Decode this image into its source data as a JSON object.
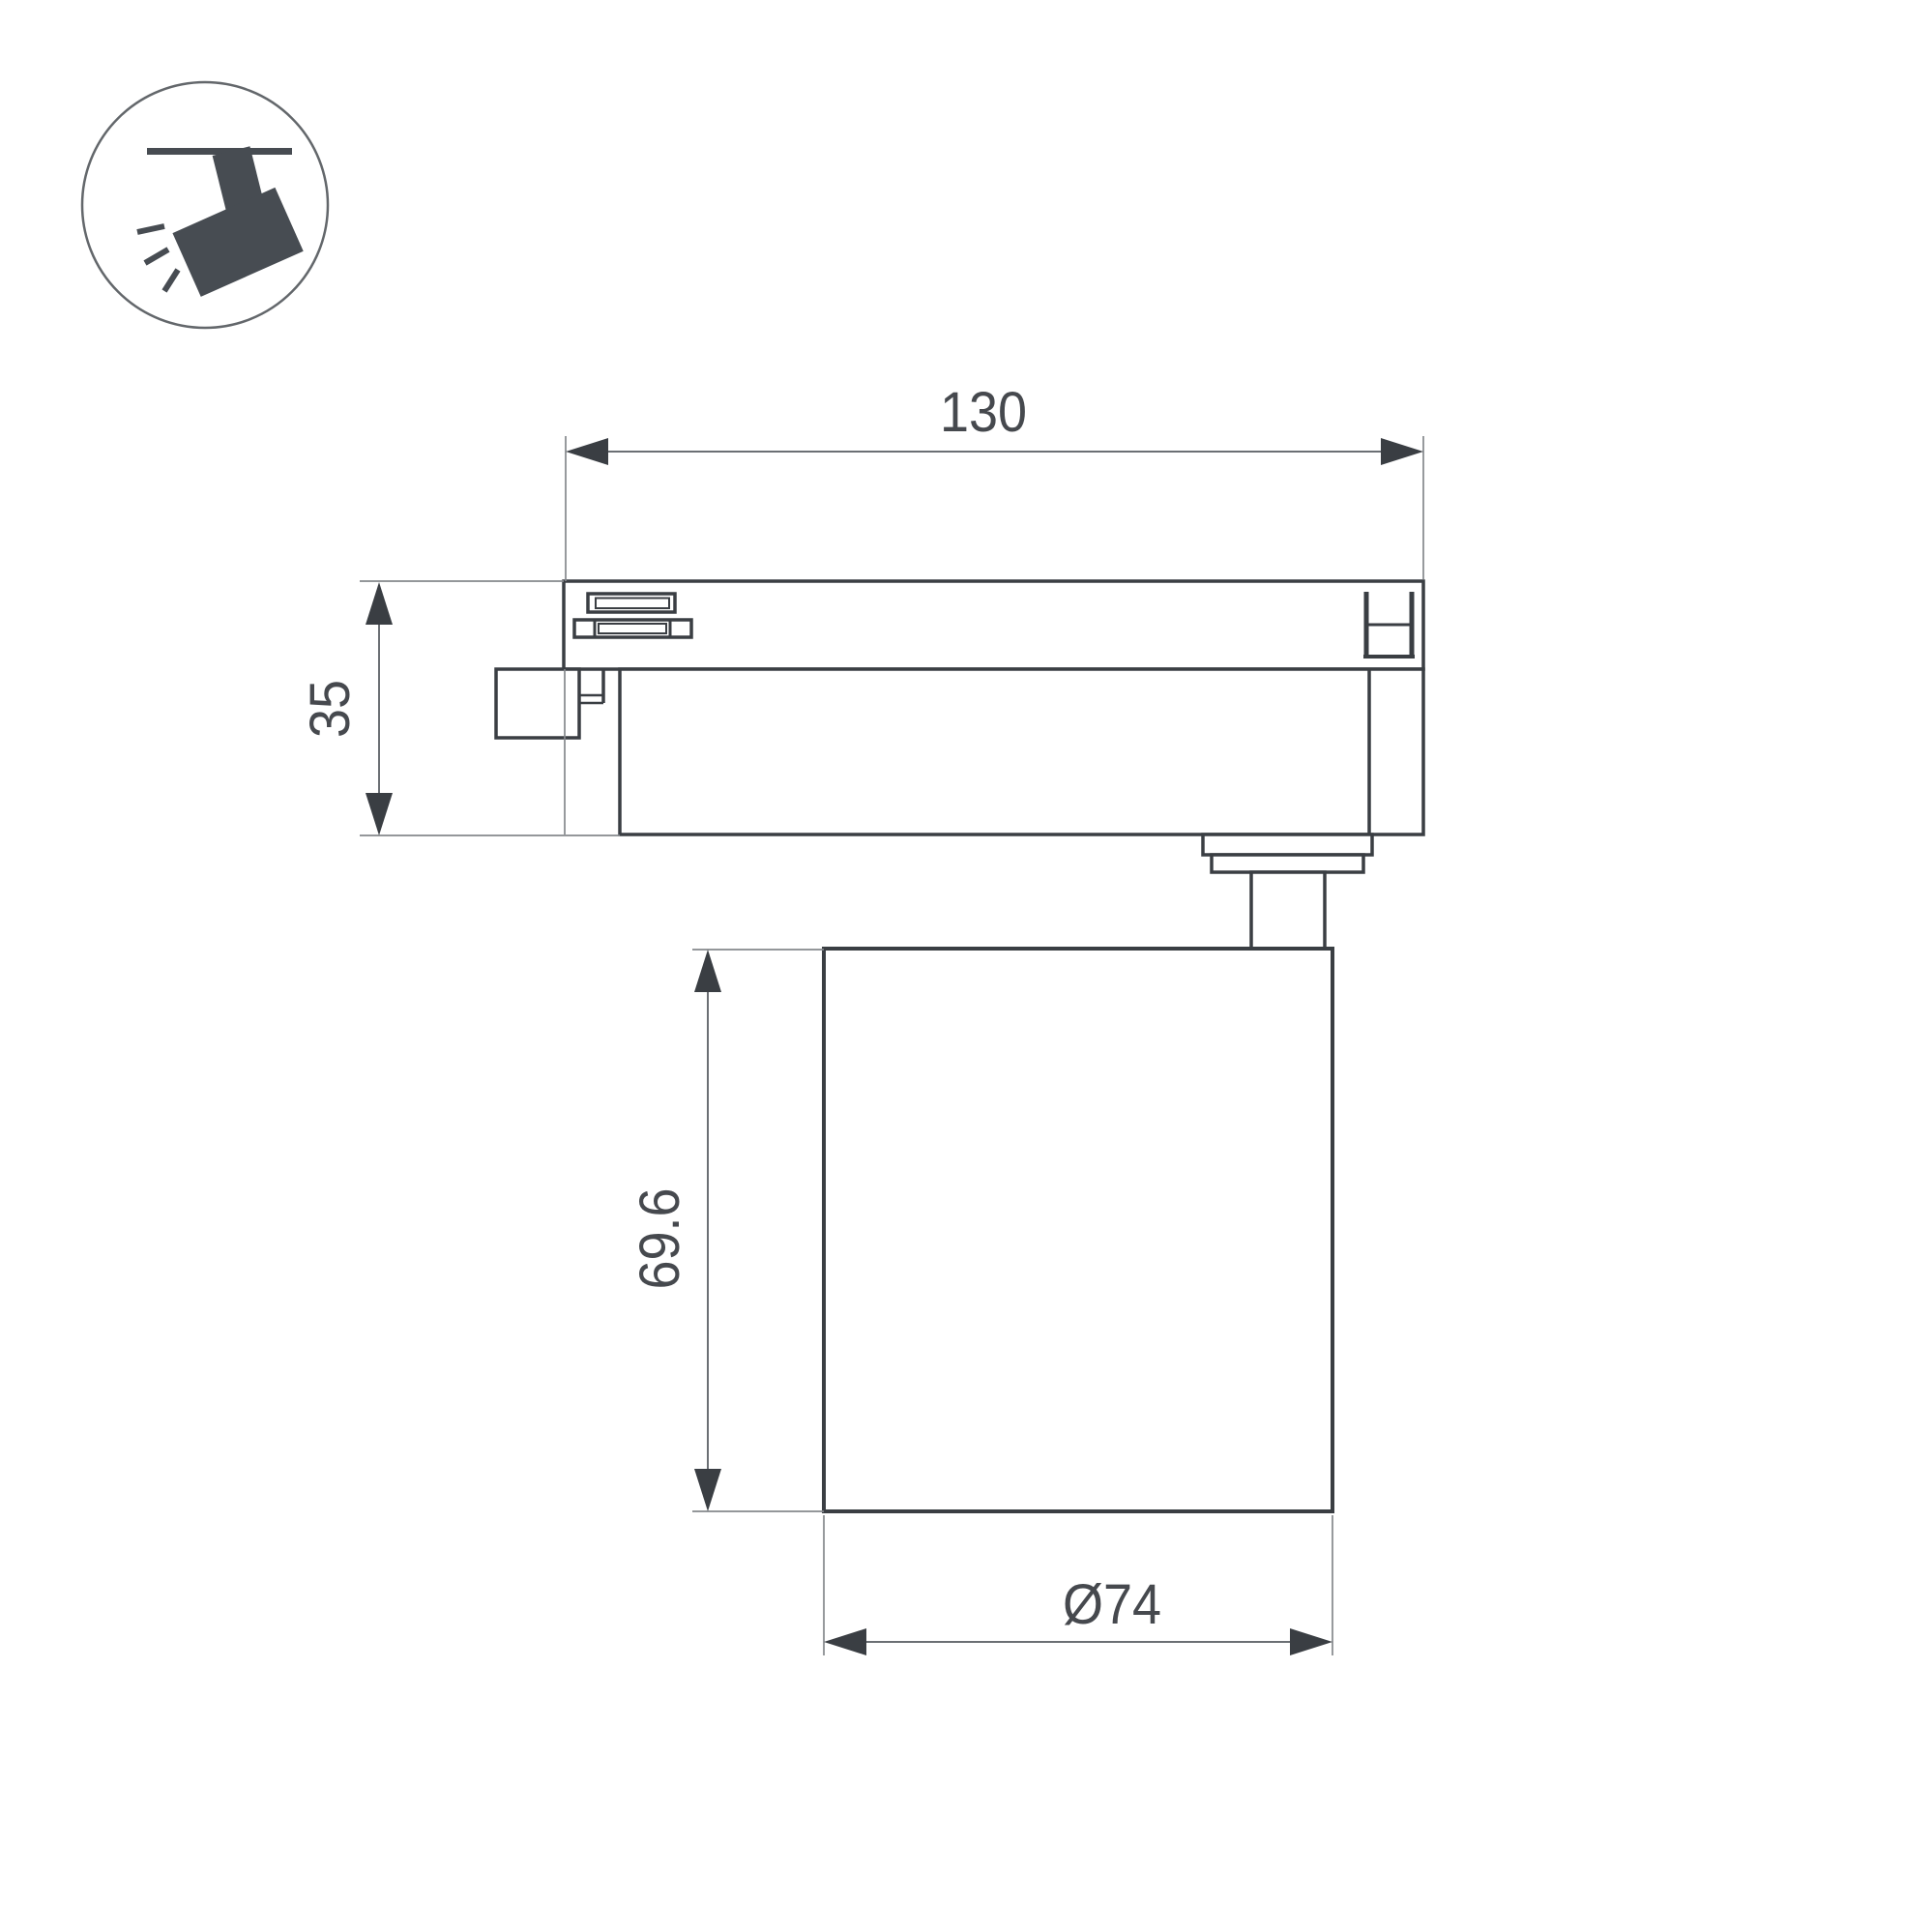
{
  "page": {
    "background_color": "#ffffff"
  },
  "legend_icon": {
    "name": "ceiling-track-spotlight-icon",
    "glyph_color": "#474c52",
    "ring_color": "#63676b"
  },
  "drawing": {
    "object_line_color": "#3a3e43",
    "dimension_line_color": "#6b6f74",
    "extension_line_color": "#85888c",
    "label_color": "#46494e",
    "dimensions": {
      "track_adapter_width": {
        "label": "130"
      },
      "track_adapter_height": {
        "label": "35"
      },
      "lamp_body_height": {
        "label": "69.6"
      },
      "lamp_body_diameter": {
        "label": "Ø74"
      }
    }
  }
}
